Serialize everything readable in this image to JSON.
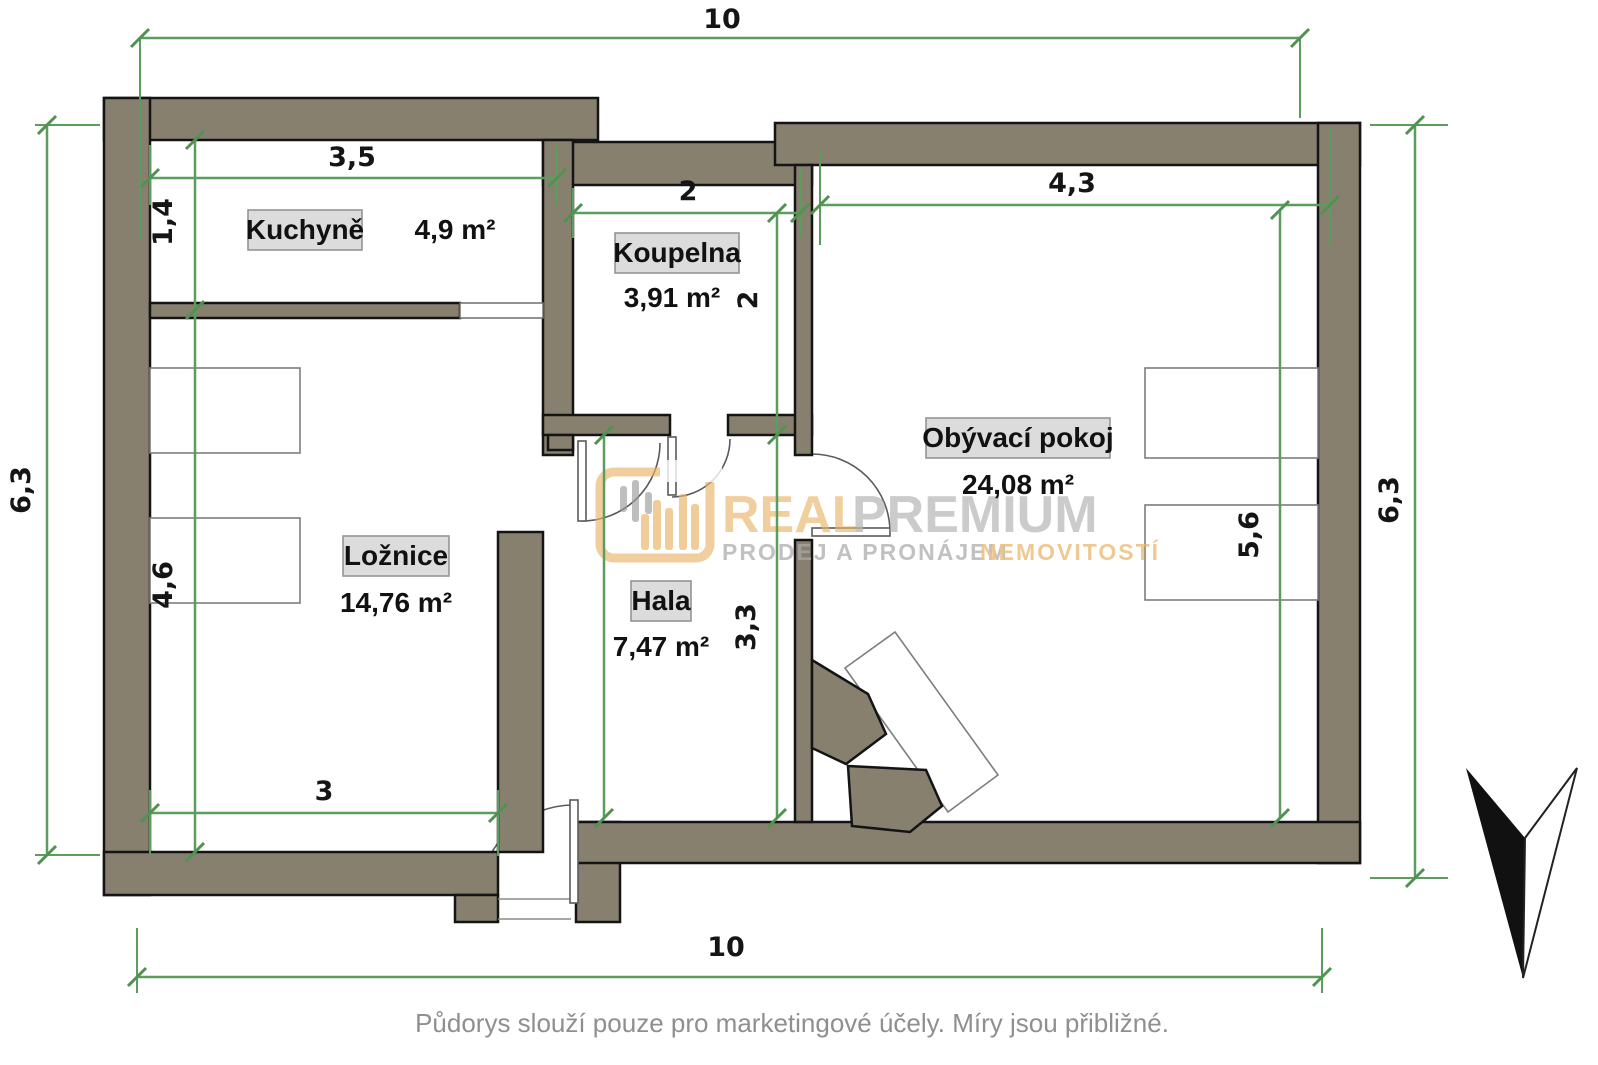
{
  "rooms": [
    {
      "id": "kuchyne",
      "name": "Kuchyně",
      "area": "4,9 m²"
    },
    {
      "id": "koupelna",
      "name": "Koupelna",
      "area": "3,91 m²"
    },
    {
      "id": "loznice",
      "name": "Ložnice",
      "area": "14,76 m²"
    },
    {
      "id": "hala",
      "name": "Hala",
      "area": "7,47 m²"
    },
    {
      "id": "obyvaci",
      "name": "Obývací pokoj",
      "area": "24,08 m²"
    }
  ],
  "dimensions": {
    "overall_width_top": "10",
    "overall_width_bottom": "10",
    "overall_height_left": "6,3",
    "overall_height_right": "6,3",
    "kitchen_width": "3,5",
    "kitchen_depth": "1,4",
    "bathroom_width": "2",
    "bathroom_depth": "2",
    "bedroom_width": "3",
    "bedroom_depth": "4,6",
    "living_width": "4,3",
    "living_depth": "5,6",
    "hall_depth": "3,3"
  },
  "logo": {
    "brand_left": "REAL",
    "brand_right": "PREMIUM",
    "tagline_left": "PRODEJ A PRONÁJEM",
    "tagline_right": "NEMOVITOSTÍ"
  },
  "footer": {
    "text": "Půdorys slouží pouze pro marketingové účely. Míry jsou přibližné."
  },
  "colors": {
    "wall": "#87806f",
    "dimension_green": "#5c9d5e",
    "label_background": "#dcdcdc",
    "logo_gold": "#e9b469",
    "logo_gray": "#b3b3b3",
    "footer_text": "#8f8f8f"
  }
}
